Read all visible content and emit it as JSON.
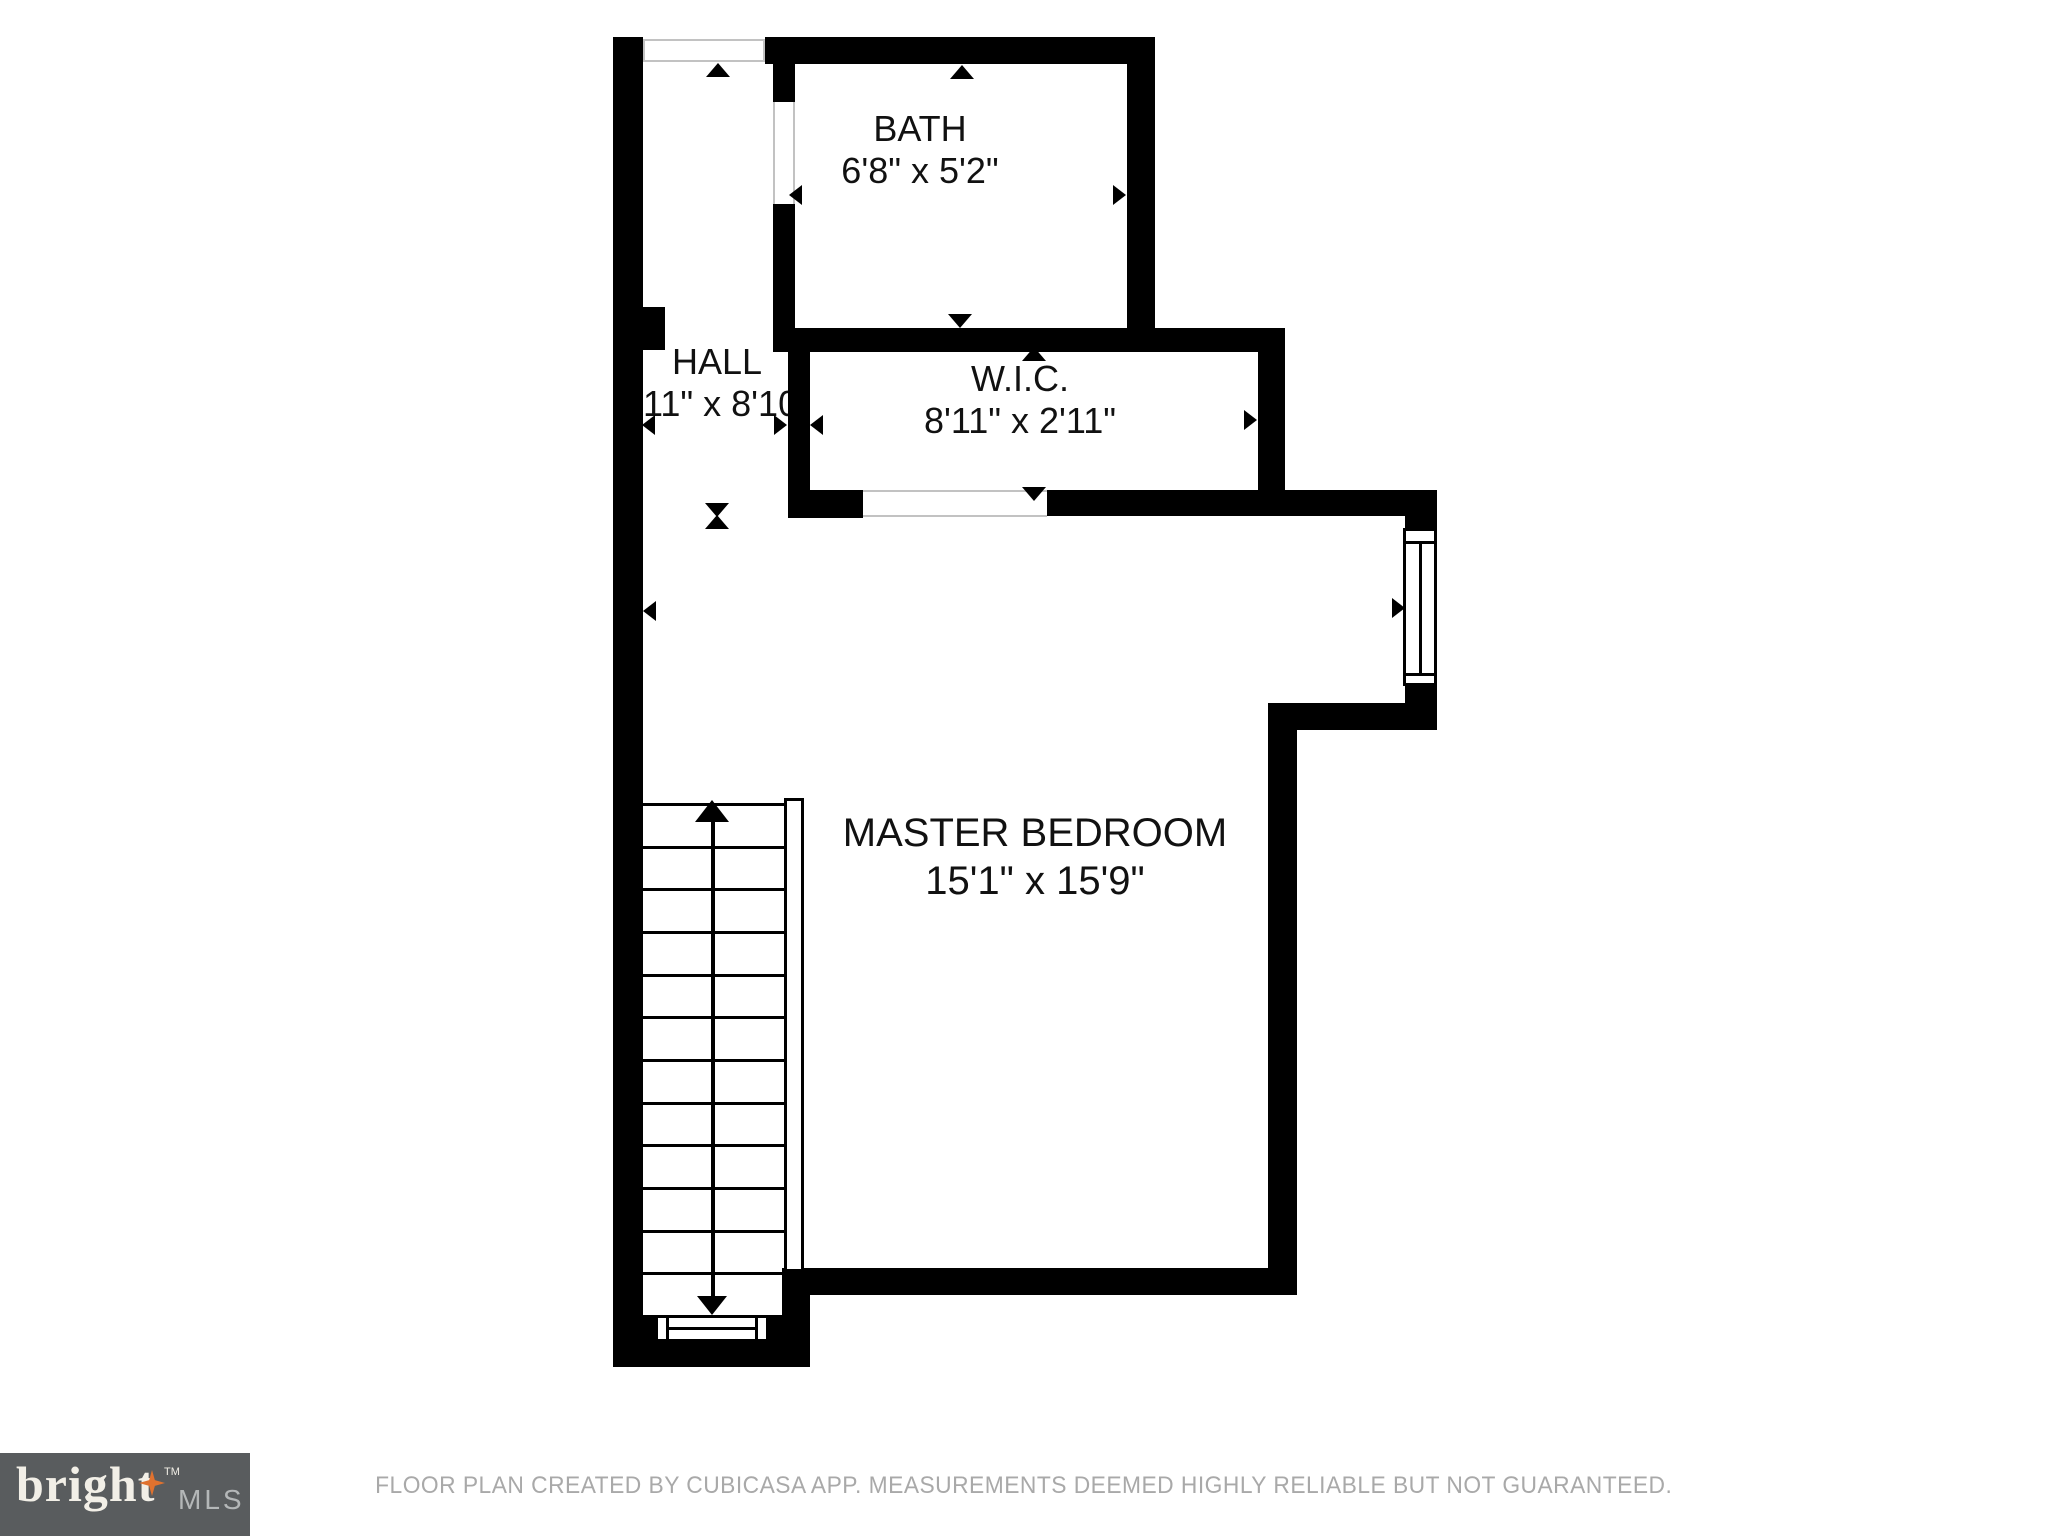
{
  "plan": {
    "rooms": [
      {
        "key": "bath",
        "name": "BATH",
        "dims": "6'8\" x 5'2\""
      },
      {
        "key": "hall",
        "name": "HALL",
        "dims": "11\" x 8'10\""
      },
      {
        "key": "wic",
        "name": "W.I.C.",
        "dims": "8'11\" x 2'11\""
      },
      {
        "key": "master",
        "name": "MASTER BEDROOM",
        "dims": "15'1\" x 15'9\""
      }
    ],
    "stairs": {
      "steps": 12,
      "direction": "up"
    }
  },
  "footer": {
    "disclaimer": "FLOOR PLAN CREATED BY CUBICASA APP. MEASUREMENTS DEEMED HIGHLY RELIABLE BUT NOT GUARANTEED."
  },
  "logo": {
    "brand": "bright",
    "trademark": "TM",
    "suffix": "MLS"
  },
  "colors": {
    "wall": "#000000",
    "label": "#111111",
    "footer_text": "#a9a9a9",
    "logo_bg": "#595c5e",
    "logo_brand": "#f2efe7",
    "logo_suffix": "#b4b7b8",
    "logo_star": "#e0722f",
    "opening_line": "#c2c2c2"
  }
}
